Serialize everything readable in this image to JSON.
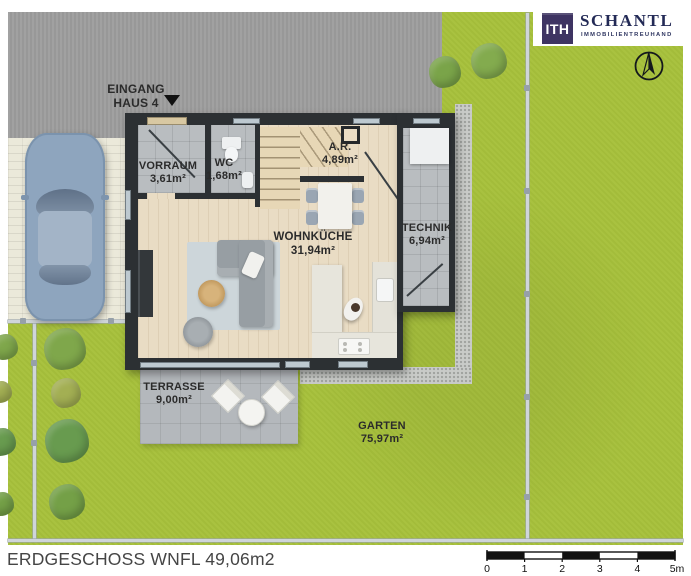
{
  "branding": {
    "logo_monogram": "ITH",
    "company": "SCHANTL",
    "tagline": "IMMOBILIENTREUHAND"
  },
  "annotations": {
    "entrance": {
      "line1": "EINGANG",
      "line2": "HAUS 4"
    }
  },
  "rooms": {
    "vorraum": {
      "name": "VORRAUM",
      "area": "3,61m²"
    },
    "wc": {
      "name": "WC",
      "area": "1,68m²"
    },
    "ar": {
      "name": "A.R.",
      "area": "4,89m²"
    },
    "wohnkueche": {
      "name": "WOHNKÜCHE",
      "area": "31,94m²"
    },
    "technik": {
      "name": "TECHNIK",
      "area": "6,94m²"
    },
    "terrasse": {
      "name": "TERRASSE",
      "area": "9,00m²"
    },
    "garten": {
      "name": "GARTEN",
      "area": "75,97m²"
    }
  },
  "footer": {
    "title": "ERDGESCHOSS WNFL 49,06m2"
  },
  "scale_bar": {
    "ticks": [
      "0",
      "1",
      "2",
      "3",
      "4",
      "5m"
    ]
  },
  "colors": {
    "grass": "#a7c13b",
    "road": "#9d9d9d",
    "wall": "#2c3033",
    "wood_floor": "#e9dcc4",
    "tile_floor": "#b9bdc0",
    "terrace": "#b4b8bc",
    "logo_purple": "#3e3462",
    "brand_navy": "#232a56"
  }
}
